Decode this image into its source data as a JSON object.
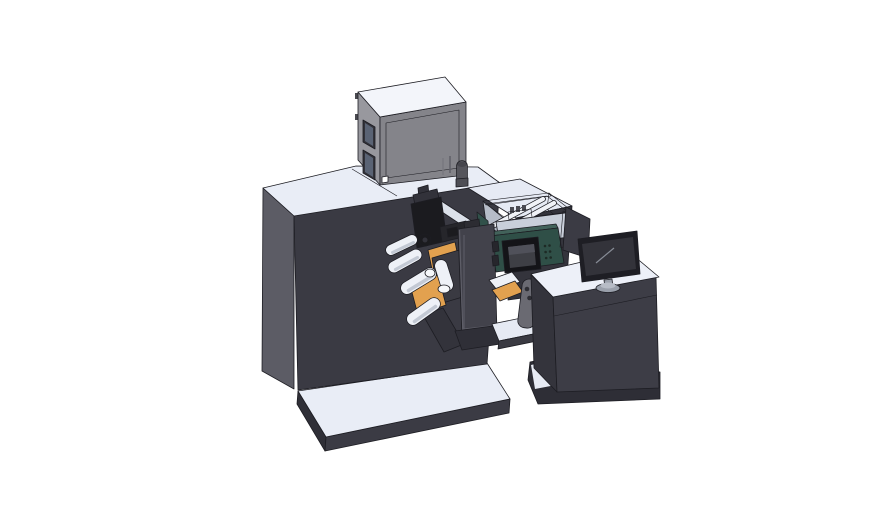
{
  "scene": {
    "type": "3d-cad-render",
    "description": "Isometric CAD rendering of an industrial label printing and converting machine: dark cabinet on a base plate, gray electronics box on top, web-guide rollers on orange mounting plates, a print-head mechanism, a parts tray, a dark-green HMI control module with blank display, and an operator desk with a monitor and divider panel",
    "background": "#ffffff",
    "monitor_screen_content": "blank",
    "hmi_screen_content": "blank"
  },
  "components": {
    "machine": {
      "label": "printing-machine",
      "parts": [
        "base-plate",
        "main-cabinet",
        "electronics-box",
        "box-windows",
        "knob-cylinder",
        "print-mechanism",
        "guide-rail",
        "orange-mount-plates",
        "web-rollers",
        "swing-door"
      ]
    },
    "tray": {
      "label": "parts-tray",
      "parts": [
        "tray-walls",
        "guide-rods",
        "parts-cluster",
        "magenta-part"
      ]
    },
    "hmi": {
      "label": "hmi-control-module",
      "parts": [
        "green-housing",
        "display-unit",
        "vent-holes",
        "connector-tabs"
      ]
    },
    "supports": {
      "label": "transfer-supports",
      "parts": [
        "white-slant",
        "orange-slant",
        "gray-bracket",
        "shelf",
        "foot-slab"
      ]
    },
    "desk": {
      "label": "operator-desk",
      "parts": [
        "desk-top",
        "desk-cabinet",
        "desk-base",
        "divider-panel",
        "monitor",
        "monitor-stand"
      ]
    }
  },
  "palette": {
    "bg": "#ffffff",
    "outline": "#1d1d23",
    "cabinet_front": "#3a3a43",
    "cabinet_left": "#5c5c65",
    "cabinet_top": "#e9edf6",
    "base_top": "#e9edf6",
    "base_front": "#3b3b44",
    "base_side": "#2f2f37",
    "platform_top": "#e6eaf4",
    "platform_front": "#34343c",
    "box_top": "#f3f5fa",
    "box_front": "#84848a",
    "box_panel": "#78787f",
    "box_left": "#98989e",
    "window_frame": "#33333a",
    "window_glass": "#5a6374",
    "hinge": "#4a4a50",
    "knob": "#55555c",
    "knob_cap": "#45454c",
    "knob_base": "#4e4e55",
    "rail_top": "#dce1ea",
    "rail_side": "#a9afbb",
    "orange": "#e2a14f",
    "plate_dark": "#3a3a42",
    "support_dark": "#33333b",
    "roller": "#eef1f7",
    "roller_shade": "#c3c9d4",
    "roller_cap": "#f6f8fb",
    "mech_dark": "#1b1b1f",
    "mech_mid": "#32323a",
    "mech_arm": "#26262b",
    "door": "#42424b",
    "door_line": "#5e5e68",
    "door_hinge": "#2c2c32",
    "tray_wall": "#c9cfda",
    "tray_wall_light": "#dfe3ec",
    "tray_left": "#b6bcc8",
    "tray_floor": "#c2c8d4",
    "tray_green": "#31514a",
    "rod": "#f0f2f7",
    "part_dark": "#4a4a52",
    "magenta": "#c060ba",
    "module_green": "#2f4f47",
    "module_green_light": "#42625a",
    "display_black": "#141418",
    "screen": "#3e3f45",
    "screen_hi": "#50515a",
    "vent": "#1d2a25",
    "tab_dark": "#26262c",
    "bracket": "#6a6a72",
    "bracket_hole": "#2e2e34",
    "shelf_top": "#e6eaf3",
    "shelf_front": "#3a3a42",
    "foot": "#2f2f37",
    "desk_top": "#edf0f8",
    "desk_front": "#3d3d46",
    "desk_left": "#34343c",
    "desk_base": "#2e2e36",
    "desk_wedge": "#e7ebf4",
    "divider": "#3b3b44",
    "divider_edge": "#d6dbe5",
    "monitor_bezel": "#1e1e24",
    "monitor_screen": "#33333a",
    "monitor_hi": "#878c96",
    "monitor_stand": "#9aa0ab",
    "monitor_stand_hi": "#b7bcc6",
    "white": "#ffffff"
  }
}
